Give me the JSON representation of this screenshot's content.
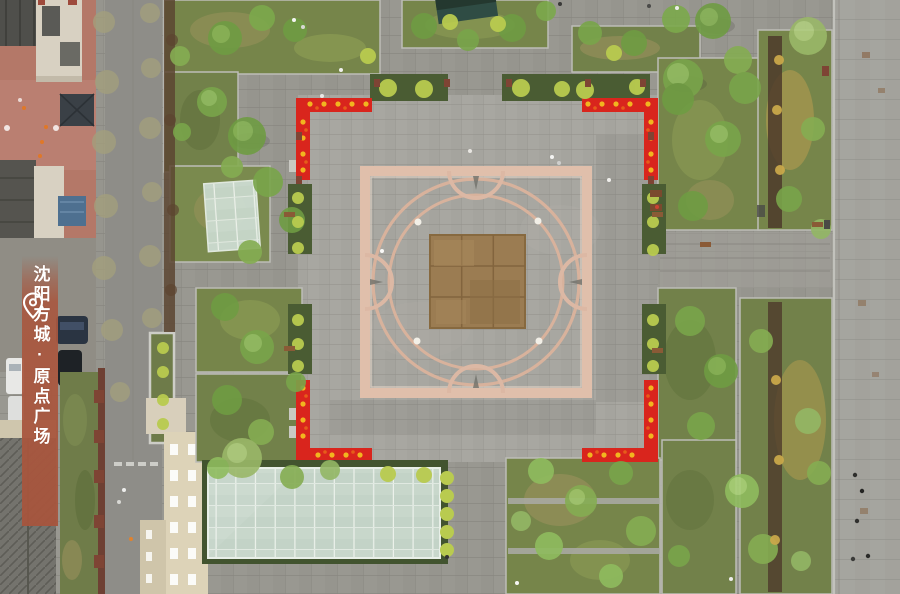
{
  "banner": {
    "icon": "location-pin",
    "text": "沈阳方城·原点广场",
    "background_color": "#a8573f",
    "text_color": "#ffffff"
  },
  "scene": {
    "type": "aerial-drone-photograph",
    "subject": "square city plaza with pink-bordered central medallion, circular paving inlay, bronze center relief, red festival corner decorations, tree planting beds, two glass canopies, streets and rooftops at the edges",
    "palette": {
      "pavement_outer": "#95948e",
      "pavement_plaza": "#a4a39d",
      "ornament_pink": "#e0bfab",
      "bronze_center": "#9b7c52",
      "festival_red": "#d9251d",
      "lantern_yellow": "#f2b51f",
      "foliage_green": "#79a54a",
      "shrub_yellow_green": "#b9cb4f",
      "hedge_dark": "#46582f",
      "glass_canopy": "#c8d8cc",
      "courtyard_red": "#b47868",
      "roof_tan": "#d8d1c2"
    }
  }
}
